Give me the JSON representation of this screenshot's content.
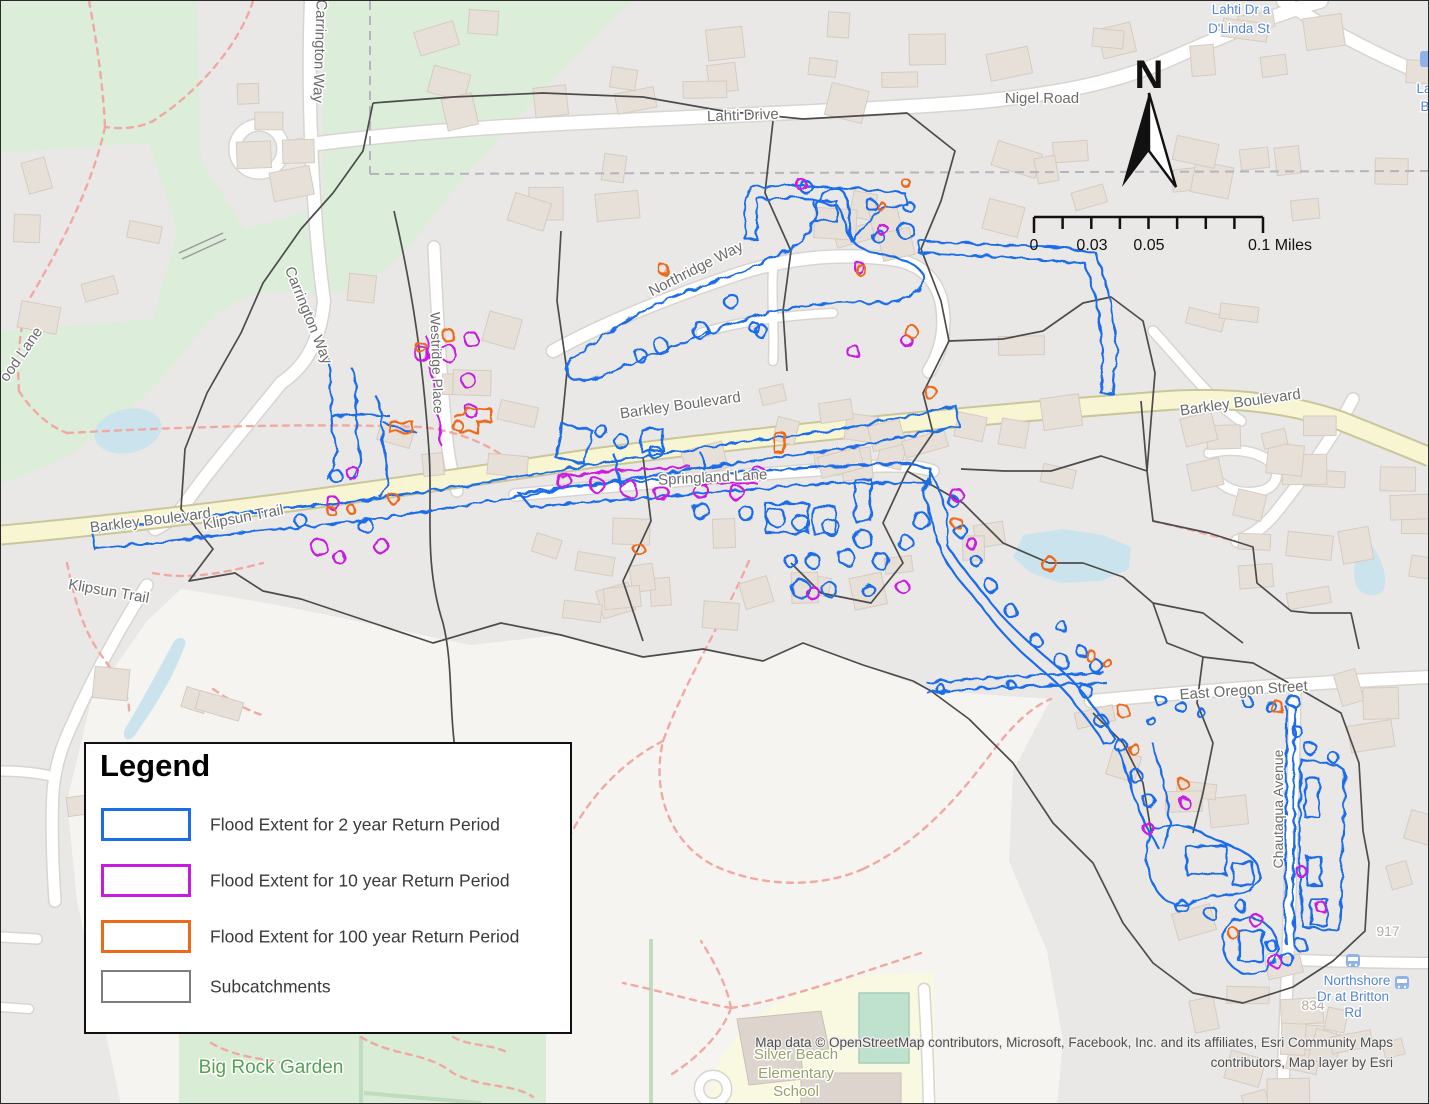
{
  "legend": {
    "title": "Legend",
    "items": [
      {
        "label": "Flood Extent for 2 year Return Period",
        "color": "#1a6ce8"
      },
      {
        "label": "Flood Extent for 10 year Return Period",
        "color": "#c81ae0"
      },
      {
        "label": "Flood Extent for 100 year Return Period",
        "color": "#ed6a1a"
      },
      {
        "label": "Subcatchments",
        "color": "#7d7d7d"
      }
    ]
  },
  "north_arrow": {
    "label": "N"
  },
  "scale_bar": {
    "labels": {
      "zero": "0",
      "mid1": "0.03",
      "mid2": "0.05",
      "end": "0.1 Miles"
    }
  },
  "attribution": {
    "line1": "Map data © OpenStreetMap contributors, Microsoft, Facebook, Inc. and its affiliates, Esri Community Maps",
    "line2": "contributors, Map layer by Esri"
  },
  "streets": {
    "lahti_drive": "Lahti Drive",
    "nigel_road": "Nigel Road",
    "carrington_way": "Carrington Way",
    "northridge_way": "Northridge Way",
    "westridge_place": "Westridge Place",
    "wood_lane": "ood Lane",
    "barkley_boulevard": "Barkley Boulevard",
    "klipsun_trail": "Klipsun Trail",
    "springland_lane": "Springland Lane",
    "east_oregon_street": "East Oregon Street",
    "chautaqua_avenue": "Chautaqua Avenue"
  },
  "places": {
    "big_rock_garden": "Big Rock Garden",
    "school_line1": "Silver Beach",
    "school_line2": "Elementary",
    "school_line3": "School",
    "house_917": "917",
    "house_834": "834"
  },
  "transit": {
    "stop1_line1": "Lahti Dr a",
    "stop1_line2": "D'Linda St",
    "stop2_line1": "Northshore",
    "stop2_line2": "Dr at Britton",
    "stop2_line3": "Rd",
    "edge_label1": "La",
    "edge_label2": "B"
  }
}
